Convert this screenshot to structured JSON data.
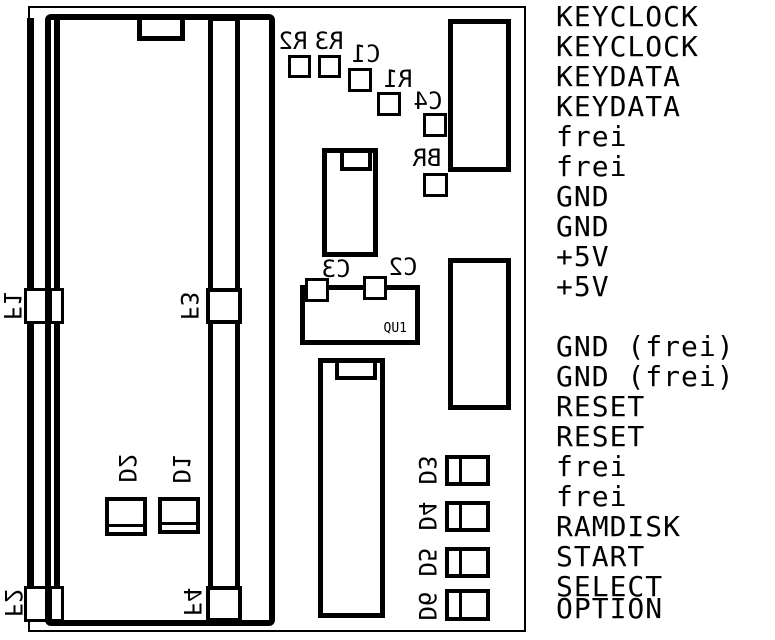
{
  "signals": {
    "upper": [
      "KEYCLOCK",
      "KEYCLOCK",
      "KEYDATA",
      "KEYDATA",
      "frei",
      "frei",
      "GND",
      "GND",
      "+5V",
      "+5V"
    ],
    "lower": [
      "GND (frei)",
      "GND (frei)",
      "RESET",
      "RESET",
      "frei",
      "frei",
      "RAMDISK",
      "START",
      "SELECT",
      "OPTION"
    ]
  },
  "components": {
    "f1": "F1",
    "f2": "F2",
    "f3": "F3",
    "f4": "F4",
    "r1": "R1",
    "r2": "R2",
    "r3": "R3",
    "c1": "C1",
    "c2": "C2",
    "c3": "C3",
    "c4": "C4",
    "br": "BR",
    "qu1": "QU1",
    "d1": "D1",
    "d2": "D2",
    "d3": "D3",
    "d4": "D4",
    "d5": "D5",
    "d6": "D6"
  },
  "colors": {
    "line": "#000000",
    "background": "#ffffff"
  }
}
